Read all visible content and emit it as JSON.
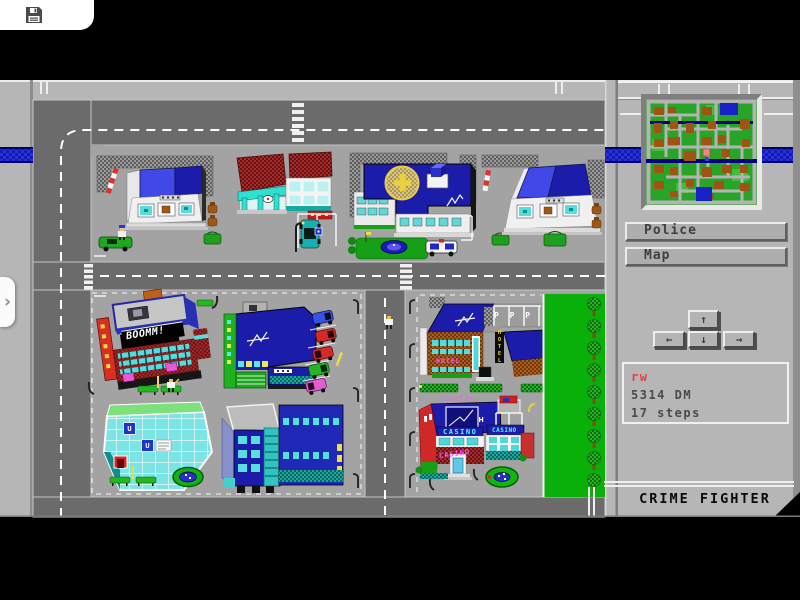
{
  "toolbar": {
    "save_icon": "floppy-disk"
  },
  "side_tab": {
    "chevron": "›"
  },
  "hud": {
    "police_button": "Police",
    "map_button": "Map",
    "dpad": {
      "up": "↑",
      "left": "←",
      "down": "↓",
      "right": "→"
    },
    "status": {
      "player": "rw",
      "money": "5314 DM",
      "steps": "17 steps"
    },
    "title": "CRIME FIGHTER"
  },
  "city_labels": {
    "boomm": "BOOMM!",
    "hotel_front": "HOTEL",
    "hotel_sign_vertical": "HOTEL",
    "hotel_roof_parking": "P P P",
    "casino_roof": "CASINO",
    "casino_marquee_left": "CASINO",
    "casino_marquee_right": "CASINO",
    "casino_entrance": "CASINO",
    "metro_sign_left": "U",
    "metro_sign_right": "U"
  },
  "colors": {
    "background": "#000000",
    "wall_gray": "#b6b6b6",
    "panel_gray": "#b9b9b9",
    "road_gray": "#6b6b6b",
    "block_gray": "#a3a3a3",
    "band_blue": "#2731dd",
    "band_border": "#000070",
    "building_navy": "#1c1caa",
    "building_blue": "#4048e8",
    "window_cyan": "#55e0e0",
    "brick_red": "#a82c2c",
    "park_green": "#0ab00a",
    "minimap_green": "#28a428",
    "minimap_brown": "#a05414",
    "status_red": "#e04040",
    "title_black": "#0a0a0a"
  }
}
